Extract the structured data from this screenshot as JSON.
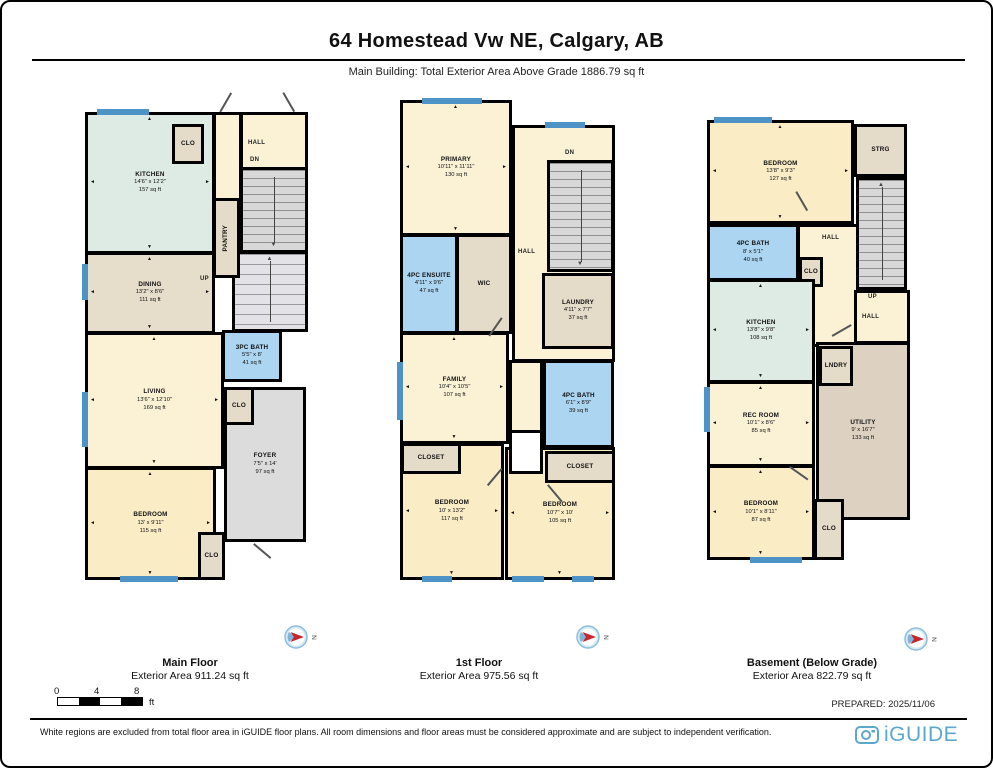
{
  "header": {
    "title": "64 Homestead Vw NE, Calgary, AB",
    "subtitle": "Main Building: Total Exterior Area Above Grade 1886.79 sq ft"
  },
  "labels": {
    "hall": "HALL",
    "dn": "DN",
    "up": "UP",
    "north": "N"
  },
  "floors": [
    {
      "name": "Main Floor",
      "area_label": "Exterior Area 911.24 sq ft",
      "rooms": {
        "kitchen": {
          "name": "KITCHEN",
          "dims": "14'6\" x 12'2\"",
          "area": "157 sq ft"
        },
        "clo_top": {
          "name": "CLO"
        },
        "pantry": {
          "name": "PANTRY"
        },
        "dining": {
          "name": "DINING",
          "dims": "13'2\" x 8'6\"",
          "area": "111 sq ft"
        },
        "bath": {
          "name": "3PC BATH",
          "dims": "5'5\" x 8'",
          "area": "41 sq ft"
        },
        "living": {
          "name": "LIVING",
          "dims": "13'6\" x 12'10\"",
          "area": "169 sq ft"
        },
        "clo_mid": {
          "name": "CLO"
        },
        "foyer": {
          "name": "FOYER",
          "dims": "7'5\" x 14'",
          "area": "97 sq ft"
        },
        "bedroom": {
          "name": "BEDROOM",
          "dims": "13' x 9'11\"",
          "area": "115 sq ft"
        },
        "clo_bot": {
          "name": "CLO"
        }
      }
    },
    {
      "name": "1st Floor",
      "area_label": "Exterior Area 975.56 sq ft",
      "rooms": {
        "primary": {
          "name": "PRIMARY",
          "dims": "10'11\" x 11'11\"",
          "area": "130 sq ft"
        },
        "ensuite": {
          "name": "4PC ENSUITE",
          "dims": "4'11\" x 9'6\"",
          "area": "47 sq ft"
        },
        "wic": {
          "name": "WIC"
        },
        "laundry": {
          "name": "LAUNDRY",
          "dims": "4'11\" x 7'7\"",
          "area": "37 sq ft"
        },
        "family": {
          "name": "FAMILY",
          "dims": "10'4\" x 10'5\"",
          "area": "107 sq ft"
        },
        "bath": {
          "name": "4PC BATH",
          "dims": "6'1\" x 8'9\"",
          "area": "39 sq ft"
        },
        "closet_l": {
          "name": "CLOSET"
        },
        "bedroom_l": {
          "name": "BEDROOM",
          "dims": "10' x 13'2\"",
          "area": "117 sq ft"
        },
        "closet_r": {
          "name": "CLOSET"
        },
        "bedroom_r": {
          "name": "BEDROOM",
          "dims": "10'7\" x 10'",
          "area": "105 sq ft"
        }
      }
    },
    {
      "name": "Basement (Below Grade)",
      "area_label": "Exterior Area 822.79 sq ft",
      "rooms": {
        "bedroom_top": {
          "name": "BEDROOM",
          "dims": "13'8\" x 9'3\"",
          "area": "127 sq ft"
        },
        "strg": {
          "name": "STRG"
        },
        "bath": {
          "name": "4PC BATH",
          "dims": "8' x 5'1\"",
          "area": "40 sq ft"
        },
        "clo_u": {
          "name": "CLO"
        },
        "kitchen": {
          "name": "KITCHEN",
          "dims": "13'8\" x 9'8\"",
          "area": "108 sq ft"
        },
        "lndry": {
          "name": "LNDRY"
        },
        "utility": {
          "name": "UTILITY",
          "dims": "9' x 16'7\"",
          "area": "133 sq ft"
        },
        "recroom": {
          "name": "REC ROOM",
          "dims": "10'1\" x 8'6\"",
          "area": "85 sq ft"
        },
        "bedroom_bot": {
          "name": "BEDROOM",
          "dims": "10'1\" x 8'11\"",
          "area": "87 sq ft"
        },
        "clo_bot": {
          "name": "CLO"
        }
      }
    }
  ],
  "footer": {
    "prepared": "PREPARED: 2025/11/06",
    "scale": {
      "t0": "0",
      "t4": "4",
      "t8": "8",
      "unit": "ft"
    },
    "disclaimer": "White regions are excluded from total floor area in iGUIDE floor plans. All room dimensions and floor areas must be considered approximate and are subject to independent verification.",
    "logo": "iGUIDE"
  },
  "colors": {
    "cream": "#FBF2D6",
    "bedroom_yellow": "#FAEDC6",
    "kitchen_teal": "#DEEBE4",
    "tan": "#E5DBC9",
    "bath_blue": "#ABD5F0",
    "foyer_gray": "#DCDCDC",
    "window_blue": "#4E93C5",
    "brand_blue": "#5AA9CD"
  }
}
